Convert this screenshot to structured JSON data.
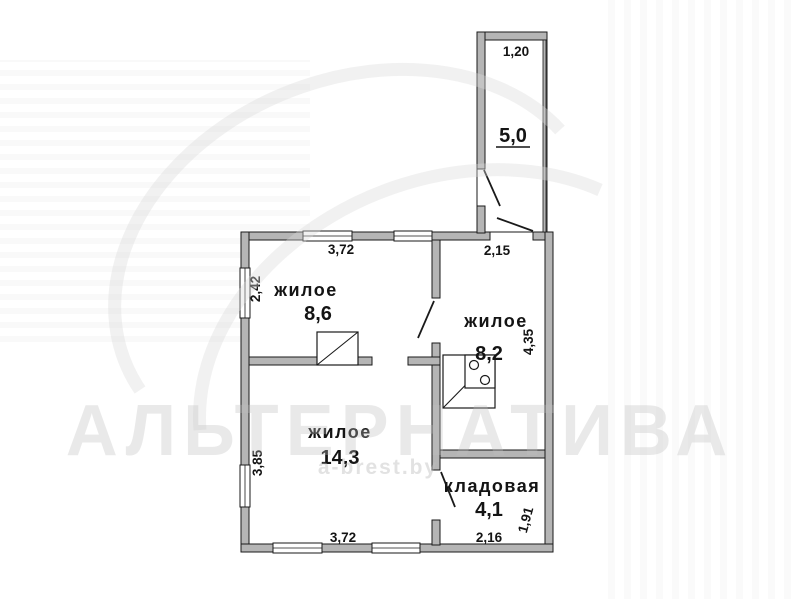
{
  "watermark": {
    "brand": "АЛЬТЕРНАТИВА",
    "site": "a-brest.by"
  },
  "rooms": [
    {
      "name": "жилое",
      "area": "8,6"
    },
    {
      "name": "жилое",
      "area": "8,2"
    },
    {
      "name": "жилое",
      "area": "14,3"
    },
    {
      "name": "кладовая",
      "area": "4,1"
    },
    {
      "name": "",
      "area": "5,0"
    }
  ],
  "dimensions": {
    "veranda_width": "1,20",
    "room1_width": "3,72",
    "room1_height": "2,42",
    "room2_width": "2,15",
    "room2_height": "4,35",
    "room3_width": "3,72",
    "room3_height": "3,85",
    "room4_width": "2,16",
    "room4_height": "1,91"
  }
}
